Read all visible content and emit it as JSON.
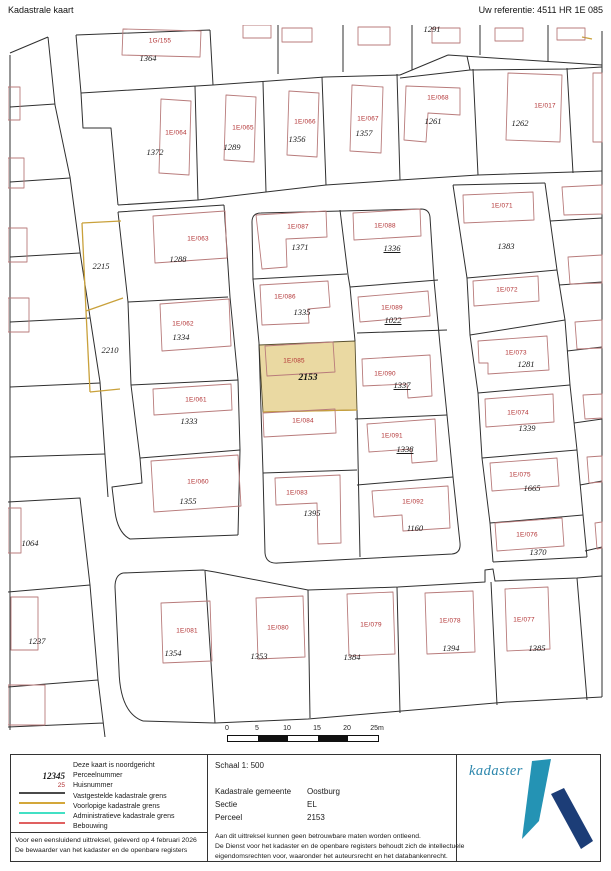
{
  "header": {
    "title": "Kadastrale kaart",
    "reference": "Uw referentie: 4511 HR 1E 085"
  },
  "map": {
    "highlight_color": "#ead9a2",
    "boundary_color": "#2f2f2f",
    "building_color": "#b87b7b",
    "provisional_color": "#c9a13b",
    "huisnummers": [
      {
        "t": "1G/155",
        "x": 152,
        "y": 16
      },
      {
        "t": "1E/064",
        "x": 168,
        "y": 108
      },
      {
        "t": "1E/065",
        "x": 235,
        "y": 103
      },
      {
        "t": "1E/066",
        "x": 297,
        "y": 97
      },
      {
        "t": "1E/067",
        "x": 360,
        "y": 94
      },
      {
        "t": "1E/068",
        "x": 430,
        "y": 73
      },
      {
        "t": "1E/017",
        "x": 537,
        "y": 81
      },
      {
        "t": "1E/063",
        "x": 190,
        "y": 214
      },
      {
        "t": "1E/087",
        "x": 290,
        "y": 202
      },
      {
        "t": "1E/088",
        "x": 377,
        "y": 201
      },
      {
        "t": "1E/071",
        "x": 494,
        "y": 181
      },
      {
        "t": "1E/086",
        "x": 277,
        "y": 272
      },
      {
        "t": "1E/089",
        "x": 384,
        "y": 283
      },
      {
        "t": "1E/072",
        "x": 499,
        "y": 265
      },
      {
        "t": "1E/062",
        "x": 175,
        "y": 299
      },
      {
        "t": "1E/085",
        "x": 286,
        "y": 336
      },
      {
        "t": "1E/090",
        "x": 377,
        "y": 349
      },
      {
        "t": "1E/073",
        "x": 508,
        "y": 328
      },
      {
        "t": "1E/061",
        "x": 188,
        "y": 375
      },
      {
        "t": "1E/084",
        "x": 295,
        "y": 396
      },
      {
        "t": "1E/074",
        "x": 510,
        "y": 388
      },
      {
        "t": "1E/091",
        "x": 384,
        "y": 411
      },
      {
        "t": "1E/060",
        "x": 190,
        "y": 457
      },
      {
        "t": "1E/075",
        "x": 512,
        "y": 450
      },
      {
        "t": "1E/083",
        "x": 289,
        "y": 468
      },
      {
        "t": "1E/092",
        "x": 405,
        "y": 477
      },
      {
        "t": "1E/076",
        "x": 519,
        "y": 510
      },
      {
        "t": "1E/081",
        "x": 179,
        "y": 606
      },
      {
        "t": "1E/080",
        "x": 270,
        "y": 603
      },
      {
        "t": "1E/079",
        "x": 363,
        "y": 600
      },
      {
        "t": "1E/078",
        "x": 442,
        "y": 596
      },
      {
        "t": "1E/077",
        "x": 516,
        "y": 595
      }
    ],
    "perceelnummers": [
      {
        "t": "1364",
        "x": 140,
        "y": 33
      },
      {
        "t": "1291",
        "x": 424,
        "y": 4
      },
      {
        "t": "1372",
        "x": 147,
        "y": 127
      },
      {
        "t": "1289",
        "x": 224,
        "y": 122
      },
      {
        "t": "1356",
        "x": 289,
        "y": 114
      },
      {
        "t": "1357",
        "x": 356,
        "y": 108
      },
      {
        "t": "1261",
        "x": 425,
        "y": 96
      },
      {
        "t": "1262",
        "x": 512,
        "y": 98
      },
      {
        "t": "2215",
        "x": 93,
        "y": 241
      },
      {
        "t": "1288",
        "x": 170,
        "y": 234
      },
      {
        "t": "1371",
        "x": 292,
        "y": 222
      },
      {
        "t": "1336",
        "x": 384,
        "y": 223,
        "u": true
      },
      {
        "t": "1383",
        "x": 498,
        "y": 221
      },
      {
        "t": "1335",
        "x": 294,
        "y": 287
      },
      {
        "t": "1022",
        "x": 385,
        "y": 295,
        "u": true
      },
      {
        "t": "2210",
        "x": 102,
        "y": 325
      },
      {
        "t": "1334",
        "x": 173,
        "y": 312
      },
      {
        "t": "2153",
        "x": 300,
        "y": 353,
        "sel": true
      },
      {
        "t": "1337",
        "x": 394,
        "y": 360,
        "u": true
      },
      {
        "t": "1281",
        "x": 518,
        "y": 339
      },
      {
        "t": "1333",
        "x": 181,
        "y": 396
      },
      {
        "t": "1339",
        "x": 519,
        "y": 403
      },
      {
        "t": "1338",
        "x": 397,
        "y": 424,
        "u": true
      },
      {
        "t": "1355",
        "x": 180,
        "y": 476
      },
      {
        "t": "1665",
        "x": 524,
        "y": 463
      },
      {
        "t": "1395",
        "x": 304,
        "y": 488
      },
      {
        "t": "1160",
        "x": 407,
        "y": 503
      },
      {
        "t": "1064",
        "x": 22,
        "y": 518
      },
      {
        "t": "1370",
        "x": 530,
        "y": 527
      },
      {
        "t": "1237",
        "x": 29,
        "y": 616
      },
      {
        "t": "1354",
        "x": 165,
        "y": 628
      },
      {
        "t": "1353",
        "x": 251,
        "y": 631
      },
      {
        "t": "1384",
        "x": 344,
        "y": 632
      },
      {
        "t": "1394",
        "x": 443,
        "y": 623
      },
      {
        "t": "1385",
        "x": 529,
        "y": 623
      }
    ],
    "selected_parcel": {
      "huisnummer": "1E/085",
      "perceelnummer": "2153"
    }
  },
  "scale_bar": {
    "ticks": [
      "0",
      "5",
      "10",
      "15",
      "20",
      "25m"
    ]
  },
  "legend": {
    "rows": [
      {
        "label": "Deze kaart is noordgericht"
      },
      {
        "sample": "12345",
        "type": "perceel",
        "label": "Perceelnummer"
      },
      {
        "sample": "25",
        "type": "huis",
        "label": "Huisnummer"
      },
      {
        "swatch": "#4a4a4a",
        "label": "Vastgestelde kadastrale grens"
      },
      {
        "swatch": "#d3a73a",
        "label": "Voorlopige kadastrale grens"
      },
      {
        "swatch": "#43e0c4",
        "label": "Administratieve kadastrale grens"
      },
      {
        "swatch": "#e06060",
        "label": "Bebouwing"
      }
    ]
  },
  "info": {
    "scale": "Schaal 1: 500",
    "rows": [
      {
        "label": "Kadastrale gemeente",
        "value": "Oostburg"
      },
      {
        "label": "Sectie",
        "value": "EL"
      },
      {
        "label": "Perceel",
        "value": "2153"
      }
    ]
  },
  "footer": {
    "left": [
      "Voor een eensluidend uittreksel, geleverd op 4 februari 2026",
      "De bewaarder van het kadaster en de openbare registers"
    ],
    "right": [
      "Aan dit uittreksel kunnen geen betrouwbare maten worden ontleend.",
      "De Dienst voor het kadaster en de openbare registers behoudt zich de intellectuele",
      "eigendomsrechten voor, waaronder het auteursrecht en het databankenrecht."
    ]
  },
  "logo": {
    "text": "kadaster",
    "light_blue": "#2493b4",
    "dark_blue": "#1c3d77"
  }
}
